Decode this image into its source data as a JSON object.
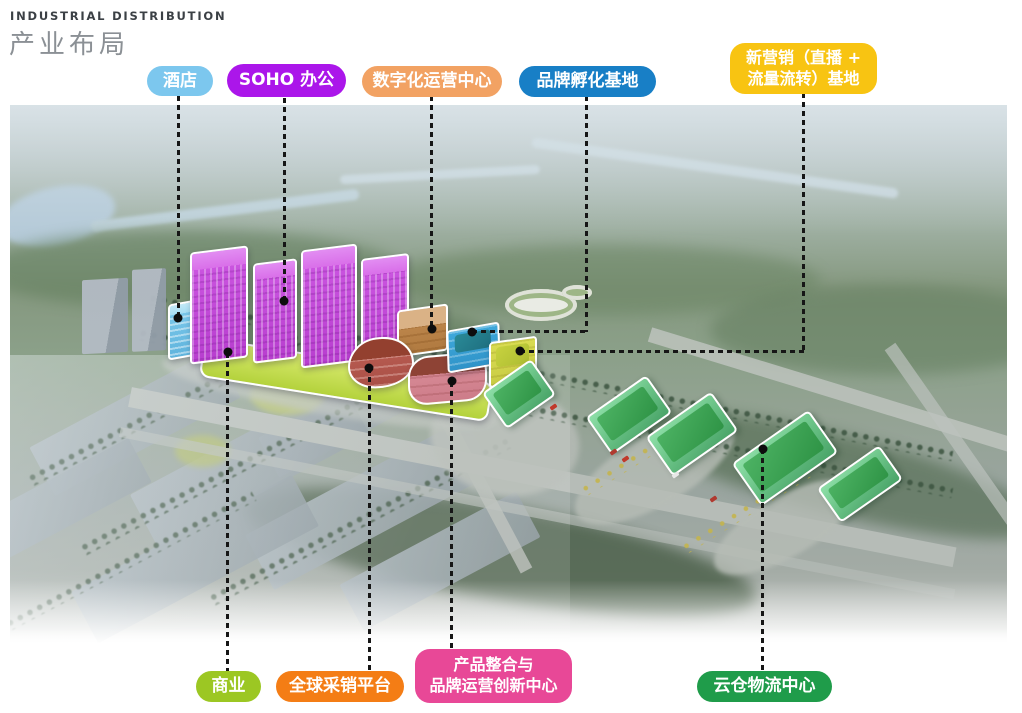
{
  "header": {
    "title_en": "INDUSTRIAL DISTRIBUTION",
    "title_zh": "产业布局"
  },
  "labels_top": [
    {
      "id": "hotel",
      "text": "酒店",
      "color": "#7cc7ee"
    },
    {
      "id": "soho-office",
      "text": "SOHO 办公",
      "color": "#ab16ea"
    },
    {
      "id": "digital-operation-center",
      "text": "数字化运营中心",
      "color": "#f2a263"
    },
    {
      "id": "brand-incubation-base",
      "text": "品牌孵化基地",
      "color": "#187fc6"
    },
    {
      "id": "new-marketing-base",
      "text": "新营销（直播 +\n流量流转）基地",
      "color": "#f8c412"
    }
  ],
  "labels_bottom": [
    {
      "id": "commerce",
      "text": "商业",
      "color": "#9cc723"
    },
    {
      "id": "global-procurement-platform",
      "text": "全球采销平台",
      "color": "#f47d15"
    },
    {
      "id": "product-integration-brand-innovation-center",
      "text": "产品整合与\n品牌运营创新中心",
      "color": "#e84897"
    },
    {
      "id": "cloud-warehouse-logistics-center",
      "text": "云仓物流中心",
      "color": "#1f9c4a"
    }
  ],
  "map_colors": {
    "hotel_building": "#7fcaec",
    "soho_buildings": "#cd58e2",
    "commerce_podium": "#c0d94e",
    "digital_building": "#c28b50",
    "procurement_building": "#bd6055",
    "product_center_building": "#db909b",
    "incubation_building": "#3fa9dc",
    "new_marketing_building": "#d9dc52",
    "logistics_buildings": "#4cb263"
  }
}
